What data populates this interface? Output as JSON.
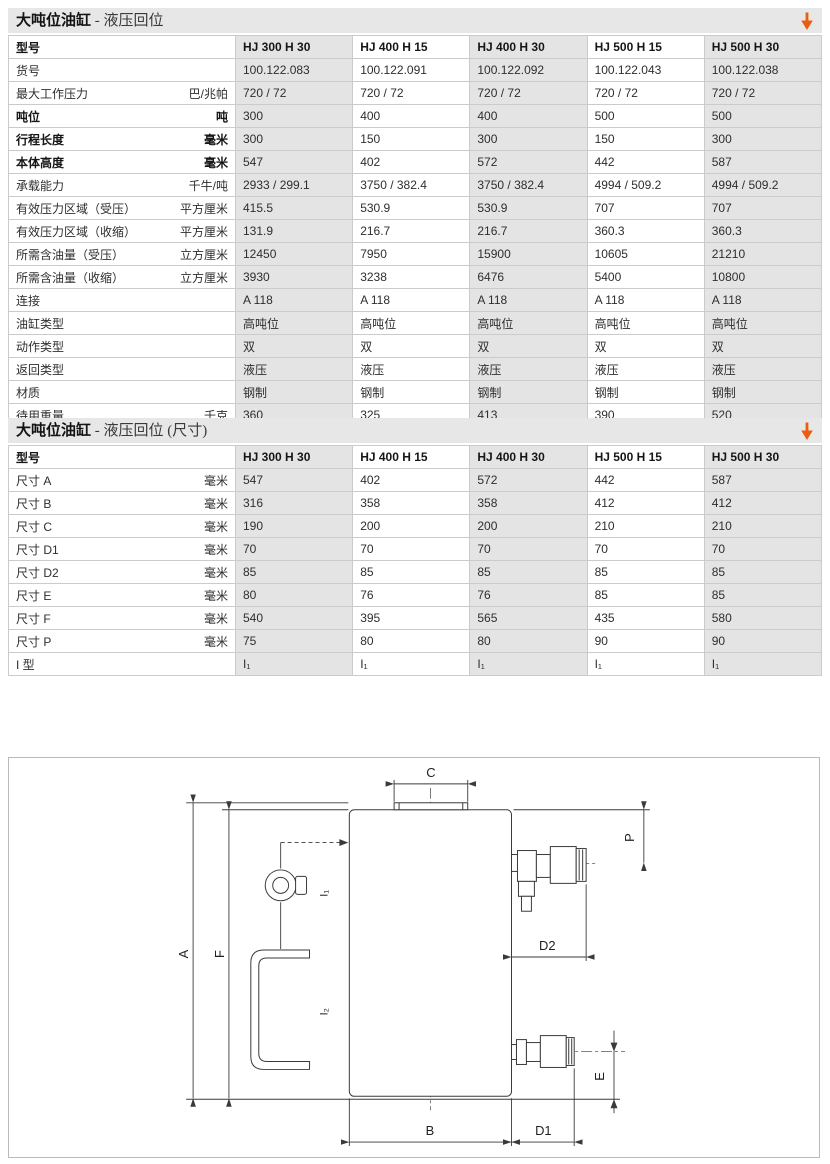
{
  "accent": {
    "orange": "#e85d11",
    "titlebar_bg": "#e7e7e7",
    "shade": "#e4e4e4",
    "grid": "#cbcbcb"
  },
  "tables": [
    {
      "title_bold": "大吨位油缸",
      "title_rest": " - 液压回位",
      "header_label": "型号",
      "columns": [
        "HJ 300 H 30",
        "HJ 400 H 15",
        "HJ 400 H 30",
        "HJ 500 H 15",
        "HJ 500 H 30"
      ],
      "rows": [
        {
          "label": "货号",
          "unit": "",
          "bold": false,
          "values": [
            "100.122.083",
            "100.122.091",
            "100.122.092",
            "100.122.043",
            "100.122.038"
          ]
        },
        {
          "label": "最大工作压力",
          "unit": "巴/兆帕",
          "bold": false,
          "values": [
            "720 / 72",
            "720 / 72",
            "720 / 72",
            "720 / 72",
            "720 / 72"
          ]
        },
        {
          "label": "吨位",
          "unit": "吨",
          "bold": true,
          "values": [
            "300",
            "400",
            "400",
            "500",
            "500"
          ]
        },
        {
          "label": "行程长度",
          "unit": "毫米",
          "bold": true,
          "values": [
            "300",
            "150",
            "300",
            "150",
            "300"
          ]
        },
        {
          "label": "本体高度",
          "unit": "毫米",
          "bold": true,
          "values": [
            "547",
            "402",
            "572",
            "442",
            "587"
          ]
        },
        {
          "label": "承载能力",
          "unit": "千牛/吨",
          "bold": false,
          "values": [
            "2933 / 299.1",
            "3750 / 382.4",
            "3750 / 382.4",
            "4994 / 509.2",
            "4994 / 509.2"
          ]
        },
        {
          "label": "有效压力区域（受压）",
          "unit": "平方厘米",
          "bold": false,
          "values": [
            "415.5",
            "530.9",
            "530.9",
            "707",
            "707"
          ]
        },
        {
          "label": "有效压力区域（收缩）",
          "unit": "平方厘米",
          "bold": false,
          "values": [
            "131.9",
            "216.7",
            "216.7",
            "360.3",
            "360.3"
          ]
        },
        {
          "label": "所需含油量（受压）",
          "unit": "立方厘米",
          "bold": false,
          "values": [
            "12450",
            "7950",
            "15900",
            "10605",
            "21210"
          ]
        },
        {
          "label": "所需含油量（收缩）",
          "unit": "立方厘米",
          "bold": false,
          "values": [
            "3930",
            "3238",
            "6476",
            "5400",
            "10800"
          ]
        },
        {
          "label": "连接",
          "unit": "",
          "bold": false,
          "values": [
            "A 118",
            "A 118",
            "A 118",
            "A 118",
            "A 118"
          ]
        },
        {
          "label": "油缸类型",
          "unit": "",
          "bold": false,
          "values": [
            "高吨位",
            "高吨位",
            "高吨位",
            "高吨位",
            "高吨位"
          ]
        },
        {
          "label": "动作类型",
          "unit": "",
          "bold": false,
          "values": [
            "双",
            "双",
            "双",
            "双",
            "双"
          ]
        },
        {
          "label": "返回类型",
          "unit": "",
          "bold": false,
          "values": [
            "液压",
            "液压",
            "液压",
            "液压",
            "液压"
          ]
        },
        {
          "label": "材质",
          "unit": "",
          "bold": false,
          "values": [
            "钢制",
            "钢制",
            "钢制",
            "钢制",
            "钢制"
          ]
        },
        {
          "label": "待用重量",
          "unit": "千克",
          "bold": false,
          "values": [
            "360",
            "325",
            "413",
            "390",
            "520"
          ]
        }
      ]
    },
    {
      "title_bold": "大吨位油缸",
      "title_rest": " - 液压回位 (尺寸)",
      "header_label": "型号",
      "columns": [
        "HJ 300 H 30",
        "HJ 400 H 15",
        "HJ 400 H 30",
        "HJ 500 H 15",
        "HJ 500 H 30"
      ],
      "rows": [
        {
          "label": "尺寸 A",
          "unit": "毫米",
          "bold": false,
          "values": [
            "547",
            "402",
            "572",
            "442",
            "587"
          ]
        },
        {
          "label": "尺寸 B",
          "unit": "毫米",
          "bold": false,
          "values": [
            "316",
            "358",
            "358",
            "412",
            "412"
          ]
        },
        {
          "label": "尺寸 C",
          "unit": "毫米",
          "bold": false,
          "values": [
            "190",
            "200",
            "200",
            "210",
            "210"
          ]
        },
        {
          "label": "尺寸 D1",
          "unit": "毫米",
          "bold": false,
          "values": [
            "70",
            "70",
            "70",
            "70",
            "70"
          ]
        },
        {
          "label": "尺寸 D2",
          "unit": "毫米",
          "bold": false,
          "values": [
            "85",
            "85",
            "85",
            "85",
            "85"
          ]
        },
        {
          "label": "尺寸 E",
          "unit": "毫米",
          "bold": false,
          "values": [
            "80",
            "76",
            "76",
            "85",
            "85"
          ]
        },
        {
          "label": "尺寸 F",
          "unit": "毫米",
          "bold": false,
          "values": [
            "540",
            "395",
            "565",
            "435",
            "580"
          ]
        },
        {
          "label": "尺寸 P",
          "unit": "毫米",
          "bold": false,
          "values": [
            "75",
            "80",
            "80",
            "90",
            "90"
          ]
        },
        {
          "label": "I 型",
          "unit": "",
          "bold": false,
          "values": [
            "I₁",
            "I₁",
            "I₁",
            "I₁",
            "I₁"
          ]
        }
      ]
    }
  ],
  "diagram": {
    "labels": {
      "a": "A",
      "b": "B",
      "c": "C",
      "d1": "D1",
      "d2": "D2",
      "e": "E",
      "f": "F",
      "p": "P",
      "i1": "I₁",
      "i2": "I₂"
    }
  }
}
